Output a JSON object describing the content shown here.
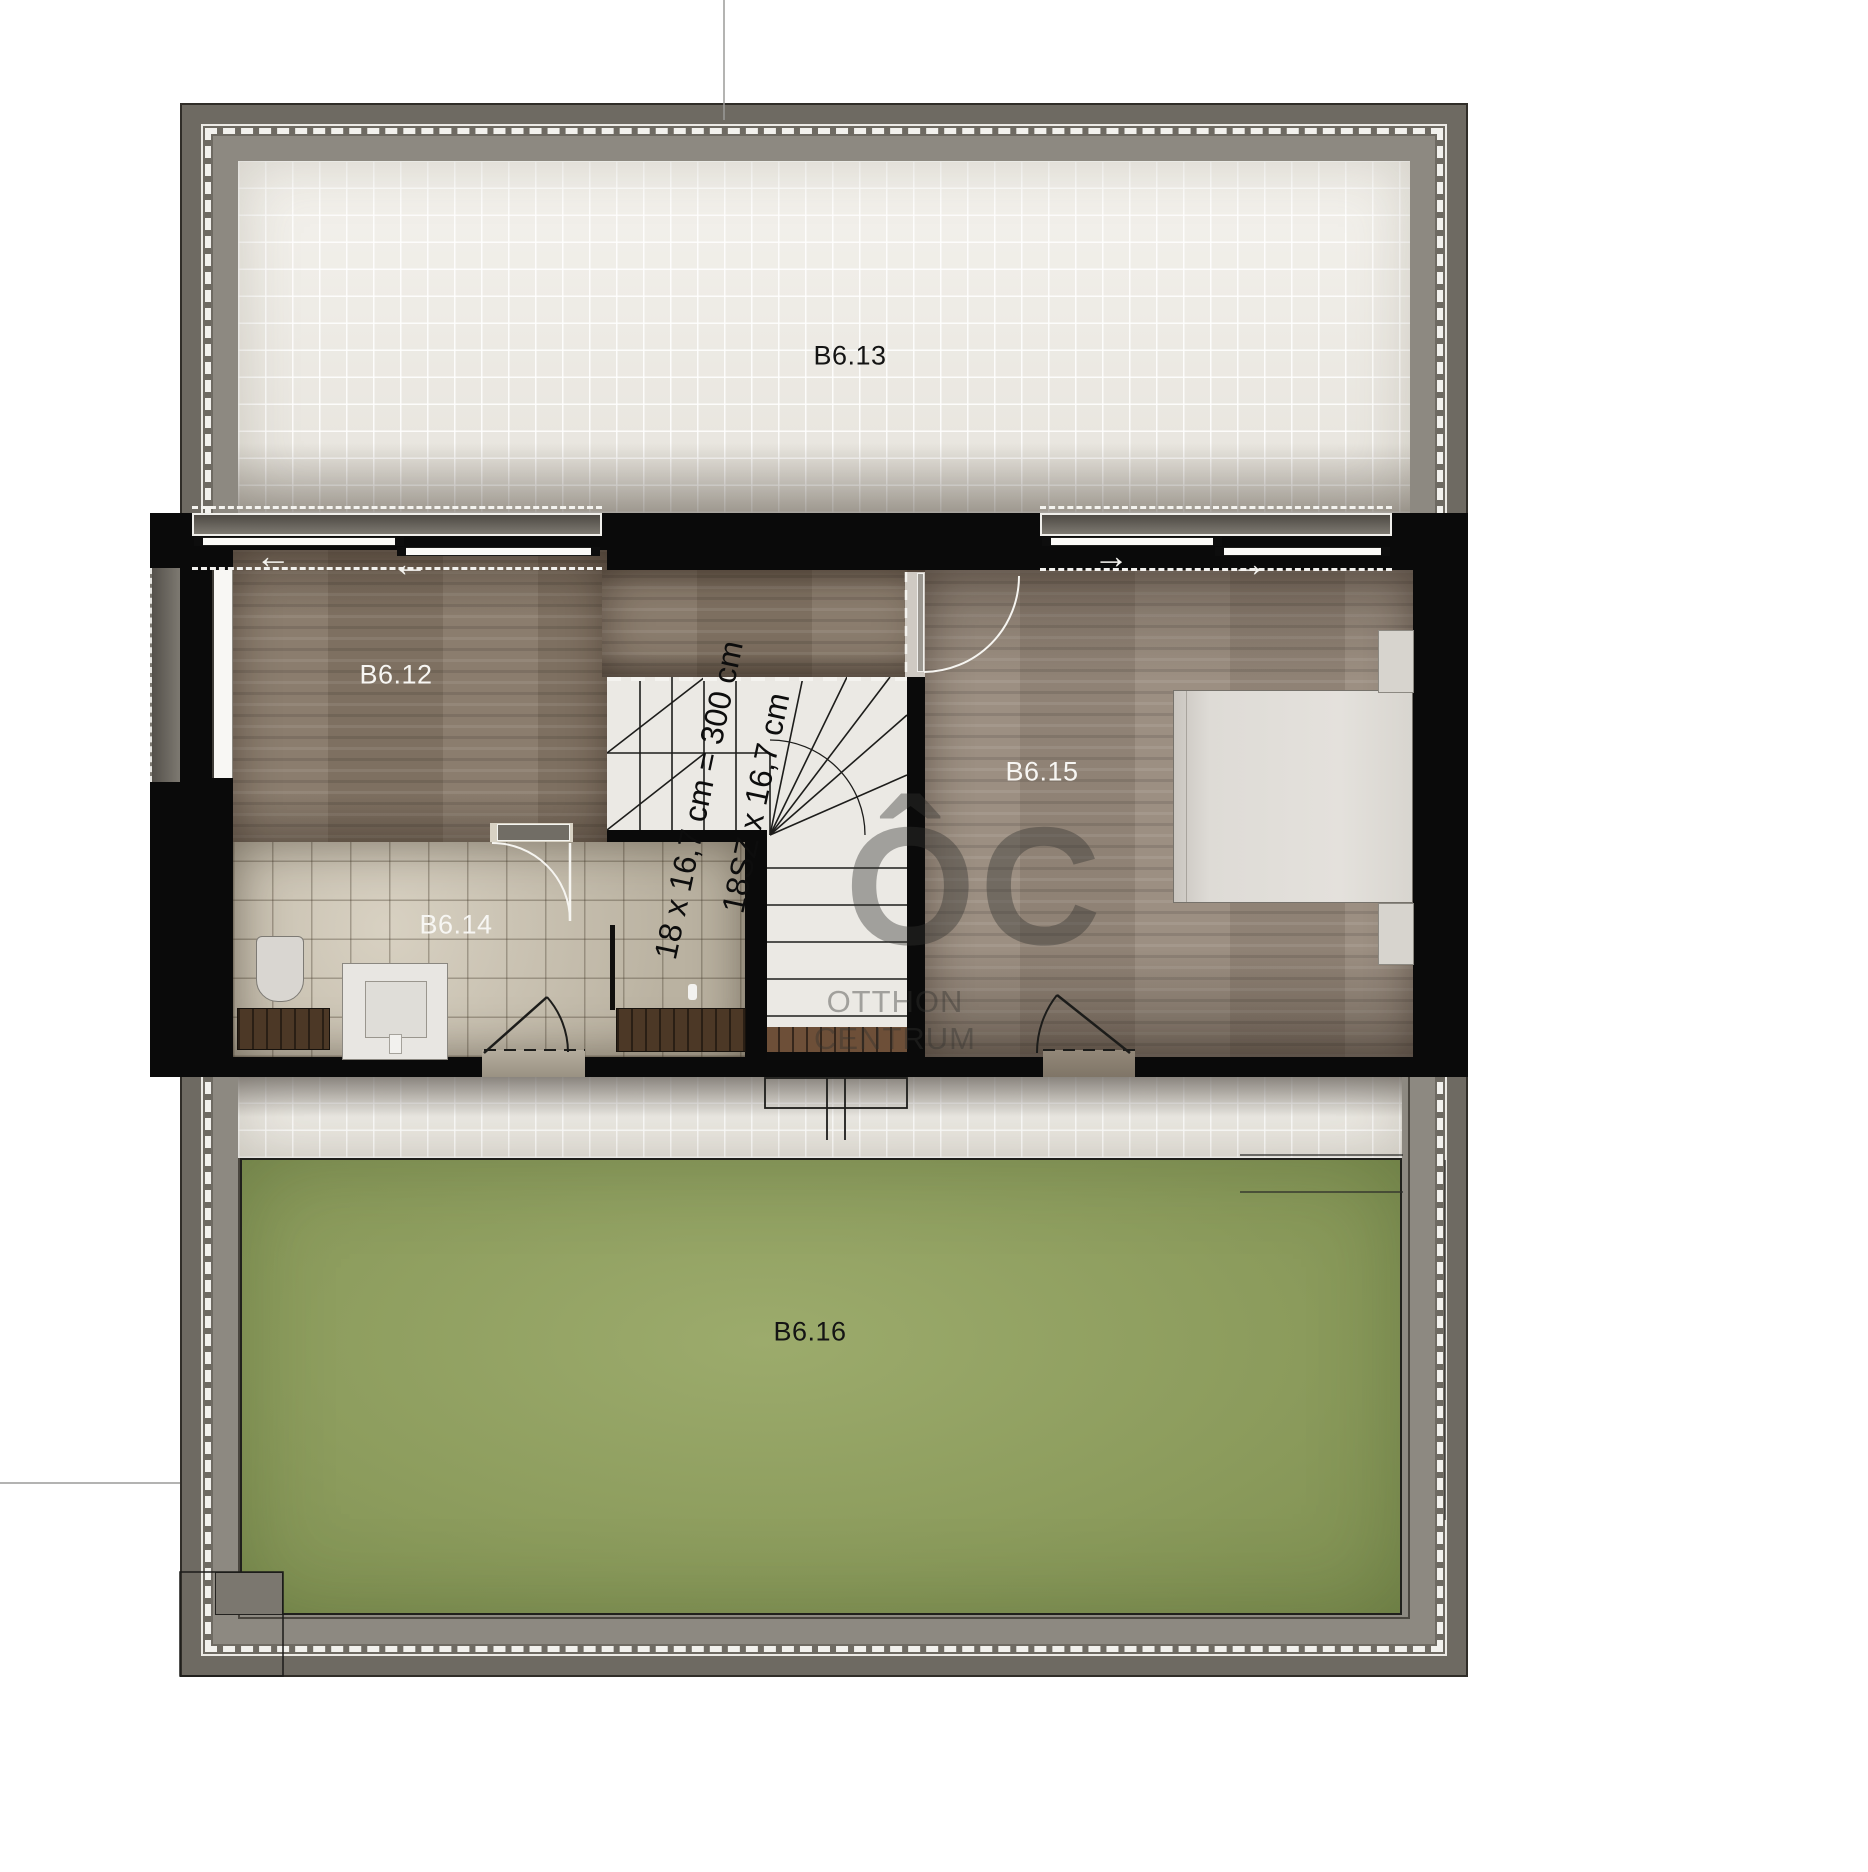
{
  "plan": {
    "rooms": [
      {
        "id": "B6.13"
      },
      {
        "id": "B6.12"
      },
      {
        "id": "B6.14"
      },
      {
        "id": "B6.15"
      },
      {
        "id": "B6.16"
      }
    ],
    "stairs": {
      "dim_line1": "18 x 16,7 cm = 300 cm",
      "dim_line2": "18SZ x 16,7 cm"
    },
    "watermark": {
      "glyphs": "ÔC",
      "line1": "OTTHON",
      "line2": "CENTRUM"
    },
    "icons": {
      "arrow_left": "←",
      "arrow_right": "→"
    },
    "colors": {
      "wall": "#0a0a0a",
      "wood_b612": "#857666",
      "wood_b615": "#97897b",
      "bath_tile": "#c8c1b1",
      "terrace_tile": "#f1eee8",
      "grass": "#8e9e60",
      "frame_gray": "#6e6a62"
    }
  }
}
